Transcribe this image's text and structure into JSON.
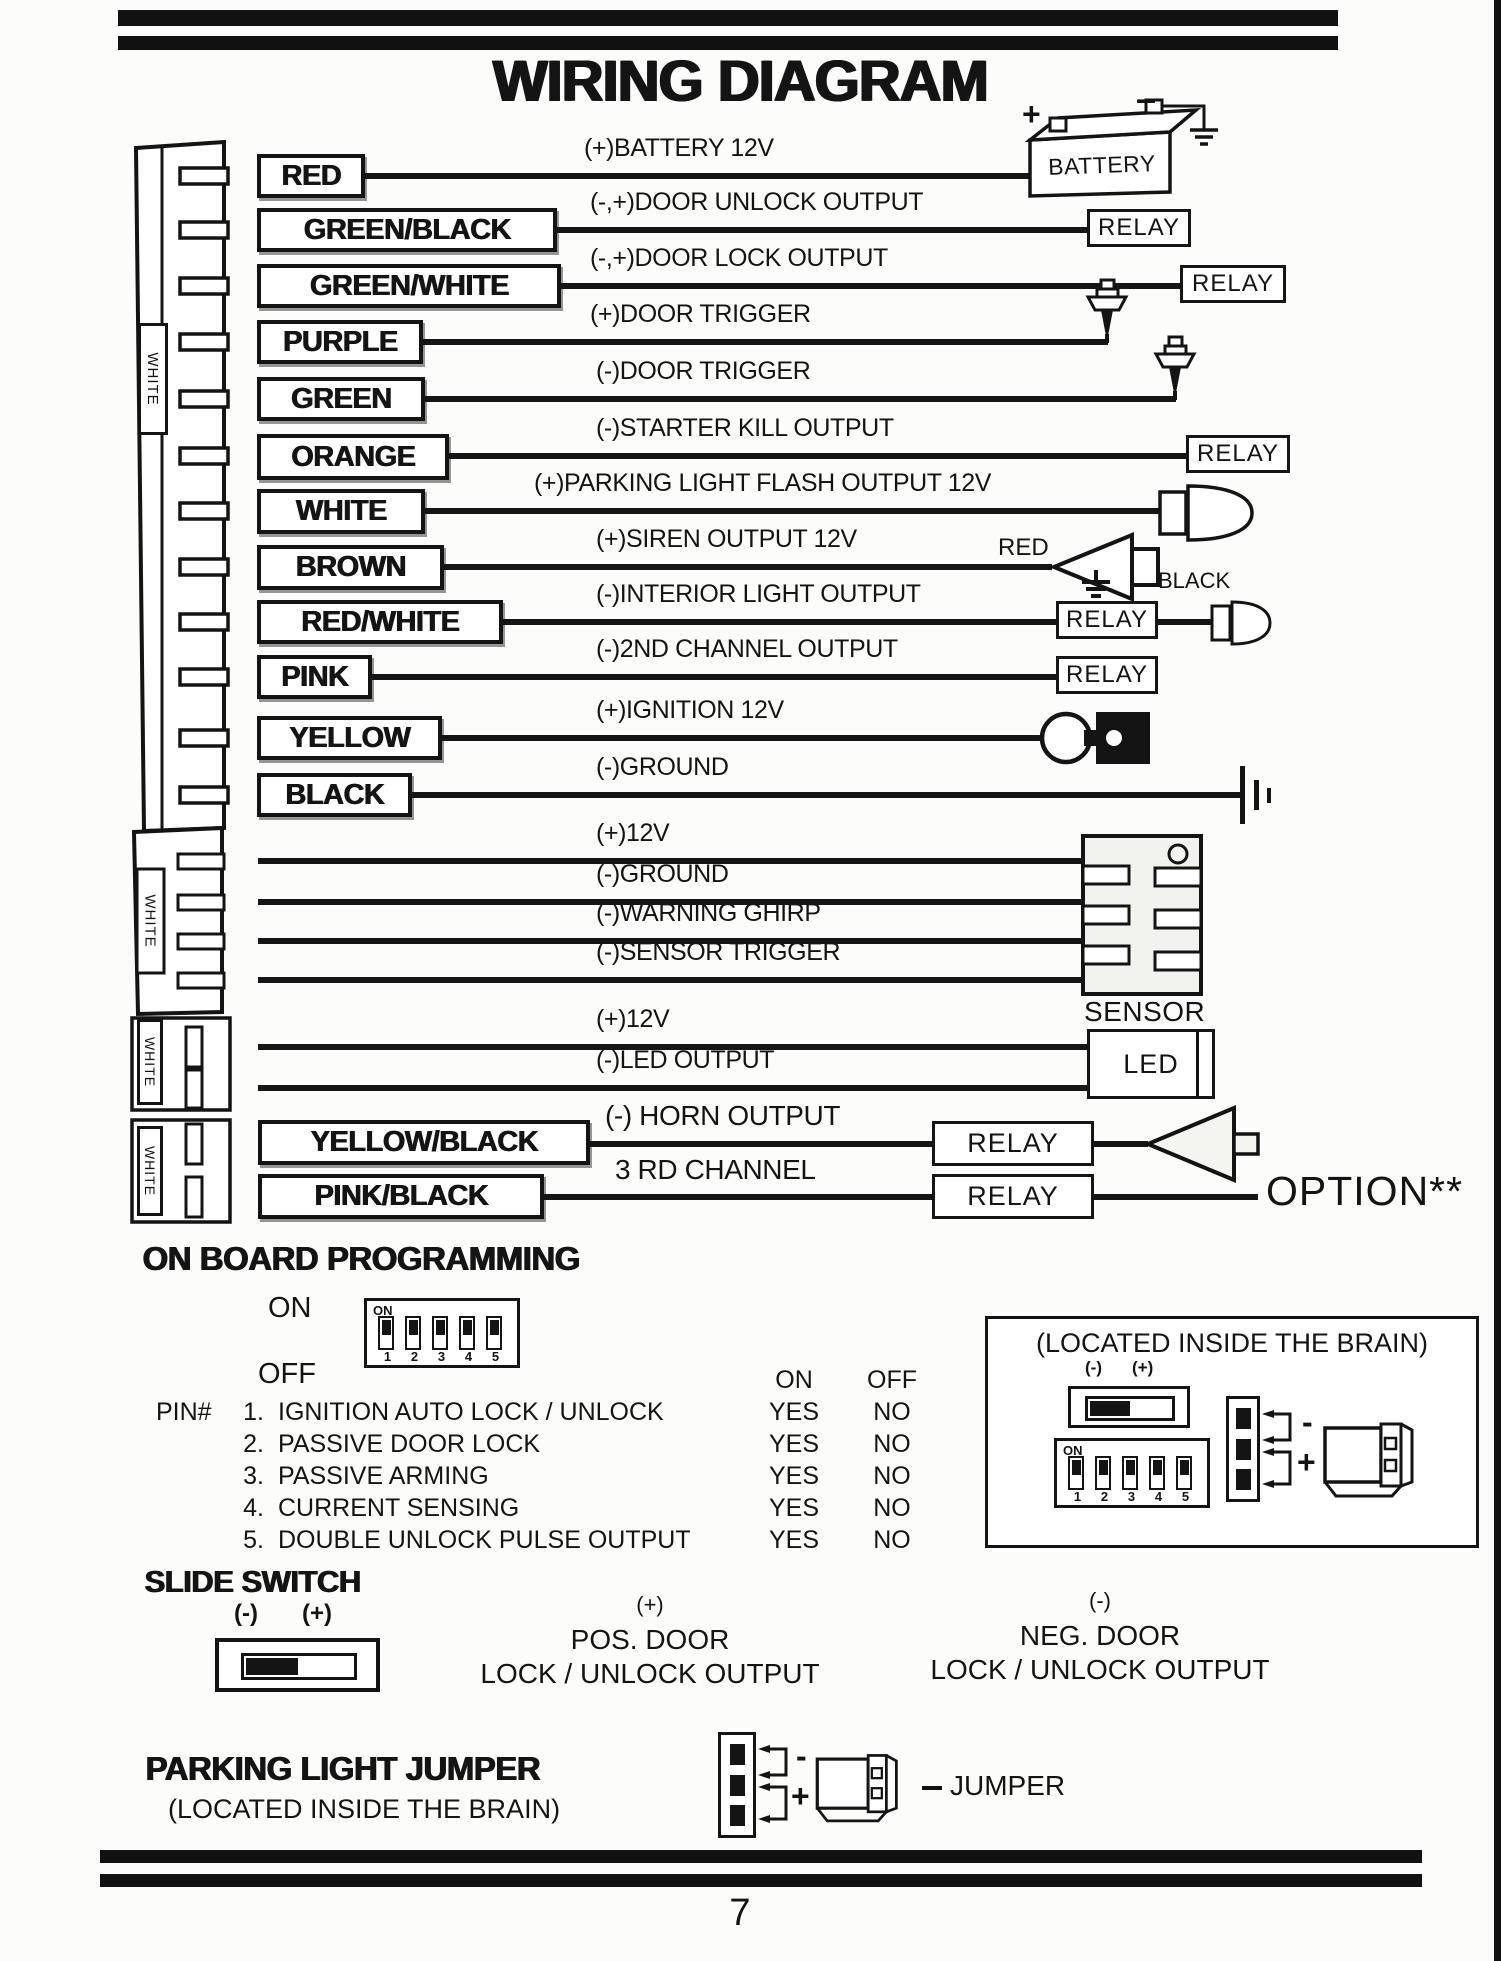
{
  "title": "WIRING DIAGRAM",
  "page_number": "7",
  "colors": {
    "ink": "#141414",
    "paper": "#fcfcfa"
  },
  "connector_labels": {
    "c1": "WHITE",
    "c2": "WHITE",
    "c3": "WHITE",
    "c4": "WHITE"
  },
  "components": {
    "battery": "BATTERY",
    "battery_plus": "+",
    "battery_minus": "–",
    "relay": "RELAY",
    "siren_red": "RED",
    "siren_black": "BLACK",
    "sensor": "SENSOR",
    "led": "LED",
    "option": "OPTION**"
  },
  "main_wires": [
    {
      "label": "RED",
      "desc": "(+)BATTERY 12V"
    },
    {
      "label": "GREEN/BLACK",
      "desc": "(-,+)DOOR UNLOCK OUTPUT"
    },
    {
      "label": "GREEN/WHITE",
      "desc": "(-,+)DOOR LOCK OUTPUT"
    },
    {
      "label": "PURPLE",
      "desc": "(+)DOOR TRIGGER"
    },
    {
      "label": "GREEN",
      "desc": "(-)DOOR TRIGGER"
    },
    {
      "label": "ORANGE",
      "desc": "(-)STARTER KILL OUTPUT"
    },
    {
      "label": "WHITE",
      "desc": "(+)PARKING LIGHT FLASH OUTPUT 12V"
    },
    {
      "label": "BROWN",
      "desc": "(+)SIREN OUTPUT 12V"
    },
    {
      "label": "RED/WHITE",
      "desc": "(-)INTERIOR LIGHT OUTPUT"
    },
    {
      "label": "PINK",
      "desc": "(-)2ND CHANNEL OUTPUT"
    },
    {
      "label": "YELLOW",
      "desc": "(+)IGNITION 12V"
    },
    {
      "label": "BLACK",
      "desc": "(-)GROUND"
    }
  ],
  "sensor_wires": [
    {
      "desc": "(+)12V"
    },
    {
      "desc": "(-)GROUND"
    },
    {
      "desc": "(-)WARNING GHIRP"
    },
    {
      "desc": "(-)SENSOR TRIGGER"
    }
  ],
  "led_wires": [
    {
      "desc": "(+)12V"
    },
    {
      "desc": "(-)LED OUTPUT"
    }
  ],
  "horn_wires": [
    {
      "label": "YELLOW/BLACK",
      "desc": "(-) HORN OUTPUT"
    },
    {
      "label": "PINK/BLACK",
      "desc": "3 RD CHANNEL"
    }
  ],
  "programming": {
    "header": "ON BOARD PROGRAMMING",
    "on": "ON",
    "off": "OFF",
    "dip_on": "ON",
    "dip_numbers": [
      "1",
      "2",
      "3",
      "4",
      "5"
    ],
    "col_on": "ON",
    "col_off": "OFF",
    "pin_prefix": "PIN#",
    "pins": [
      {
        "num": "1.",
        "name": "IGNITION AUTO LOCK / UNLOCK",
        "on": "YES",
        "off": "NO"
      },
      {
        "num": "2.",
        "name": "PASSIVE DOOR LOCK",
        "on": "YES",
        "off": "NO"
      },
      {
        "num": "3.",
        "name": "PASSIVE ARMING",
        "on": "YES",
        "off": "NO"
      },
      {
        "num": "4.",
        "name": "CURRENT SENSING",
        "on": "YES",
        "off": "NO"
      },
      {
        "num": "5.",
        "name": "DOUBLE UNLOCK PULSE OUTPUT",
        "on": "YES",
        "off": "NO"
      }
    ]
  },
  "brain_box": {
    "title": "(LOCATED INSIDE THE BRAIN)",
    "minus": "(-)",
    "plus": "(+)",
    "dip_on": "ON",
    "dip_numbers": [
      "1",
      "2",
      "3",
      "4",
      "5"
    ],
    "jumper_minus": "-",
    "jumper_plus": "+"
  },
  "slide_switch": {
    "header": "SLIDE SWITCH",
    "minus": "(-)",
    "plus": "(+)",
    "pos_sign": "(+)",
    "pos_line1": "POS. DOOR",
    "pos_line2": "LOCK / UNLOCK OUTPUT",
    "neg_sign": "(-)",
    "neg_line1": "NEG. DOOR",
    "neg_line2": "LOCK / UNLOCK OUTPUT"
  },
  "parking_jumper": {
    "header": "PARKING LIGHT JUMPER",
    "subtitle": "(LOCATED INSIDE THE BRAIN)",
    "minus": "-",
    "plus": "+",
    "label": "JUMPER"
  }
}
